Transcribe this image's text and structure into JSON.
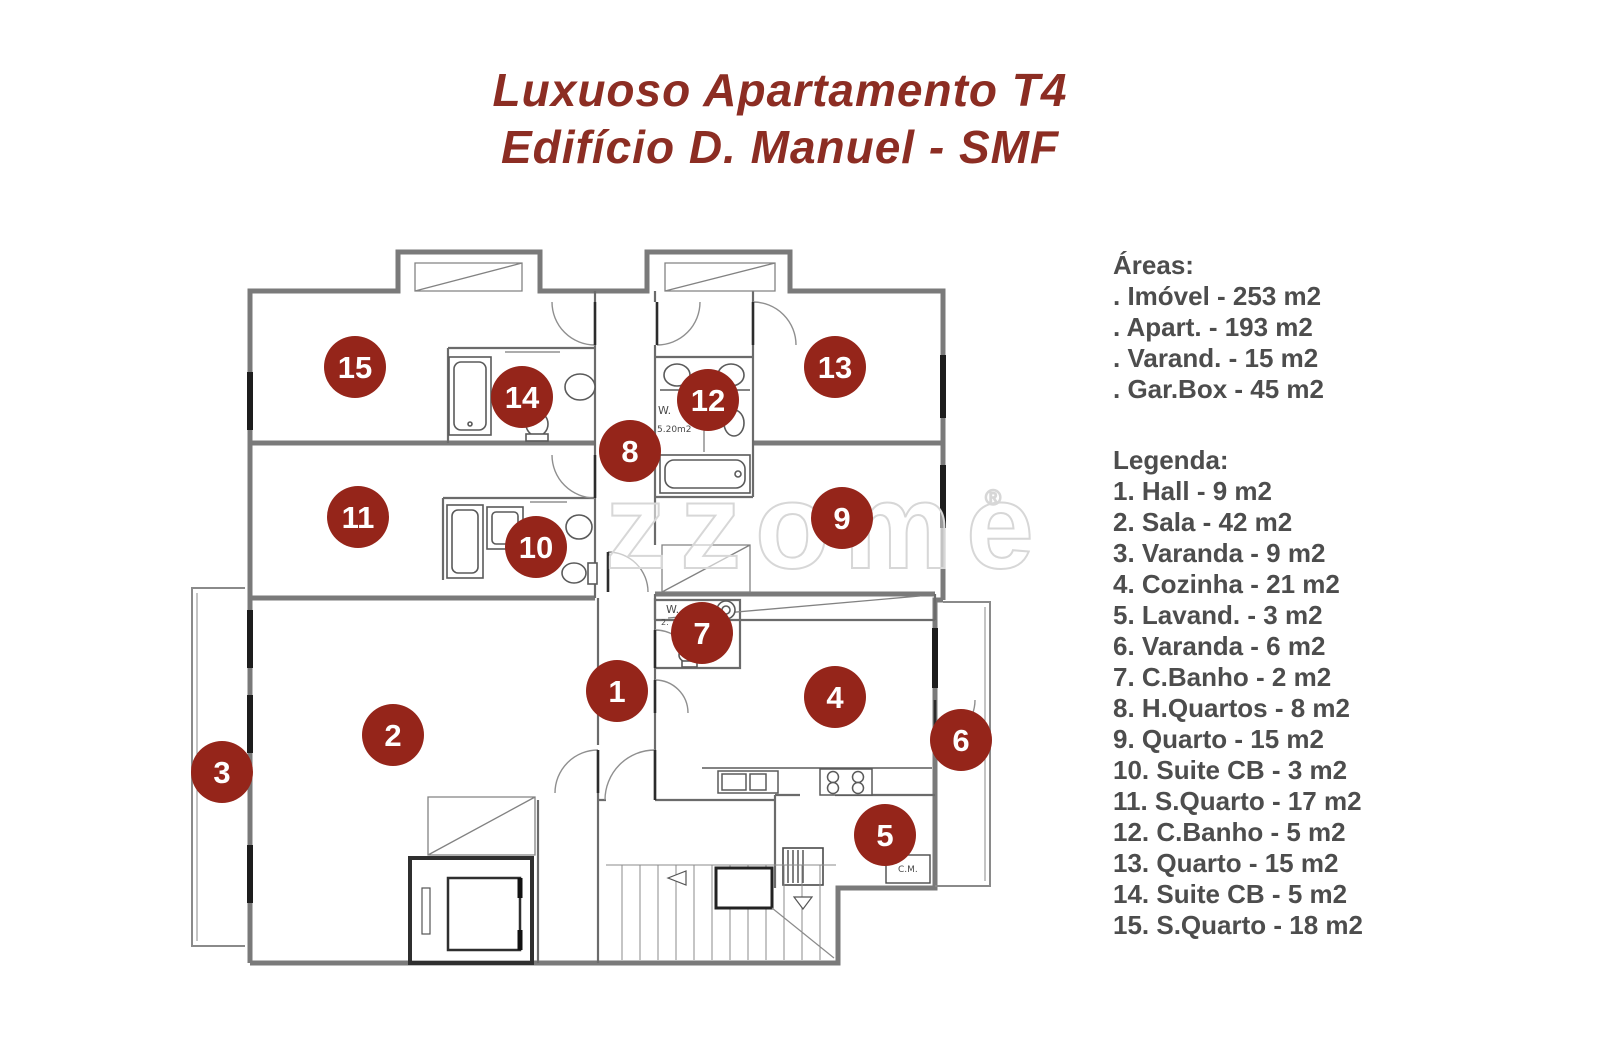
{
  "title": {
    "line1": "Luxuoso Apartamento T4",
    "line2": "Edifício D. Manuel - SMF"
  },
  "panel": {
    "areas_heading": "Áreas:",
    "areas": [
      ". Imóvel - 253 m2",
      ". Apart. - 193 m2",
      ". Varand. - 15 m2",
      ". Gar.Box - 45 m2"
    ],
    "legend_heading": "Legenda:",
    "legend": [
      "1. Hall - 9 m2",
      "2. Sala - 42 m2",
      "3. Varanda - 9 m2",
      "4. Cozinha - 21 m2",
      "5. Lavand. - 3 m2",
      "6. Varanda - 6 m2",
      "7. C.Banho - 2 m2",
      "8. H.Quartos - 8 m2",
      "9. Quarto - 15 m2",
      "10. Suite CB - 3 m2",
      "11. S.Quarto - 17 m2",
      "12. C.Banho - 5 m2",
      "13. Quarto - 15 m2",
      "14. Suite CB - 5 m2",
      "15. S.Quarto - 18 m2"
    ]
  },
  "floorplan": {
    "watermark": "zzome",
    "watermark_reg": "®",
    "marker_color": "#95251a",
    "plan_labels": [
      {
        "text": "W.",
        "x": 658,
        "y": 414,
        "size": 11
      },
      {
        "text": "5.20m2",
        "x": 657,
        "y": 432,
        "size": 9
      },
      {
        "text": "W.",
        "x": 666,
        "y": 613,
        "size": 11
      },
      {
        "text": "2.",
        "x": 661,
        "y": 625,
        "size": 8
      },
      {
        "text": "C.M.",
        "x": 898,
        "y": 872,
        "size": 9
      }
    ],
    "markers": [
      {
        "n": "1",
        "x": 617,
        "y": 691
      },
      {
        "n": "2",
        "x": 393,
        "y": 735
      },
      {
        "n": "3",
        "x": 222,
        "y": 772
      },
      {
        "n": "4",
        "x": 835,
        "y": 697
      },
      {
        "n": "5",
        "x": 885,
        "y": 835
      },
      {
        "n": "6",
        "x": 961,
        "y": 740
      },
      {
        "n": "7",
        "x": 702,
        "y": 633
      },
      {
        "n": "8",
        "x": 630,
        "y": 451
      },
      {
        "n": "9",
        "x": 842,
        "y": 518
      },
      {
        "n": "10",
        "x": 536,
        "y": 547
      },
      {
        "n": "11",
        "x": 358,
        "y": 517
      },
      {
        "n": "12",
        "x": 708,
        "y": 400
      },
      {
        "n": "13",
        "x": 835,
        "y": 367
      },
      {
        "n": "14",
        "x": 522,
        "y": 397
      },
      {
        "n": "15",
        "x": 355,
        "y": 367
      }
    ]
  }
}
